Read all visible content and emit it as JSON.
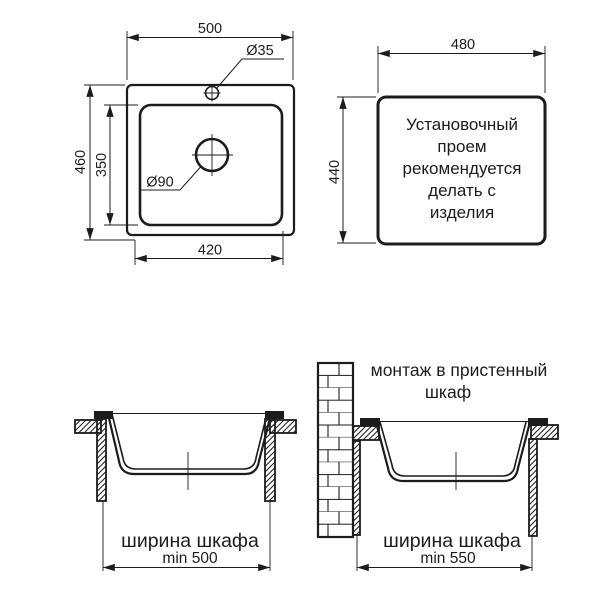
{
  "colors": {
    "line": "#1c1c1c",
    "background": "#ffffff"
  },
  "top_view": {
    "width": "500",
    "height": "460",
    "bowl_height": "350",
    "bowl_width": "420",
    "faucet_hole": "Ø35",
    "drain_hole": "Ø90"
  },
  "cutout_view": {
    "width": "480",
    "height": "440",
    "note": [
      "Установочный",
      "проем",
      "рекомендуется",
      "делать с",
      "изделия"
    ]
  },
  "cabinet_standard": {
    "label": "ширина шкафа",
    "min": "min 500"
  },
  "cabinet_wall": {
    "title": [
      "монтаж в пристенный",
      "шкаф"
    ],
    "label": "ширина шкафа",
    "min": "min 550"
  }
}
